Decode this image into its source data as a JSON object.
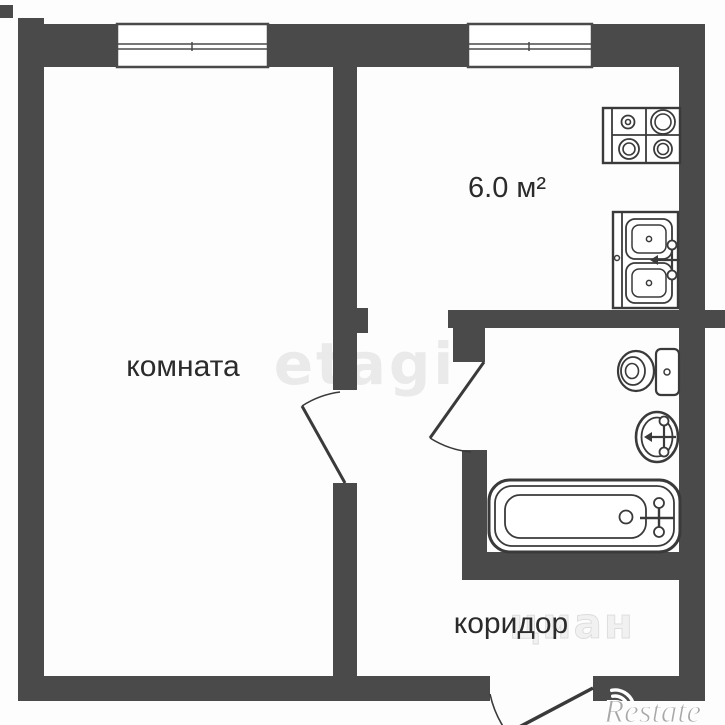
{
  "labels": {
    "room": "комната",
    "kitchen_area": "6.0 м²",
    "corridor": "коридор"
  },
  "values": {
    "kitchen_area_m2": "6.0"
  },
  "watermarks": {
    "center": "etagi",
    "corner_brand": "Restate",
    "fragment": "циан"
  },
  "icons": {
    "stove": "stove-icon",
    "kitchen_sink": "kitchen-sink-icon",
    "toilet": "toilet-icon",
    "washbasin": "washbasin-icon",
    "bathtub": "bathtub-icon",
    "window": "window-icon",
    "door_swing": "door-swing-icon",
    "signal": "signal-arcs-icon"
  },
  "colors": {
    "wall": "#4a4a4a",
    "fixture_line": "#3a3a3a",
    "label_text": "#2b2b2b",
    "watermark_light": "#eaeaea",
    "watermark_corner": "#a8a8a8",
    "background": "#fdfdfd"
  }
}
